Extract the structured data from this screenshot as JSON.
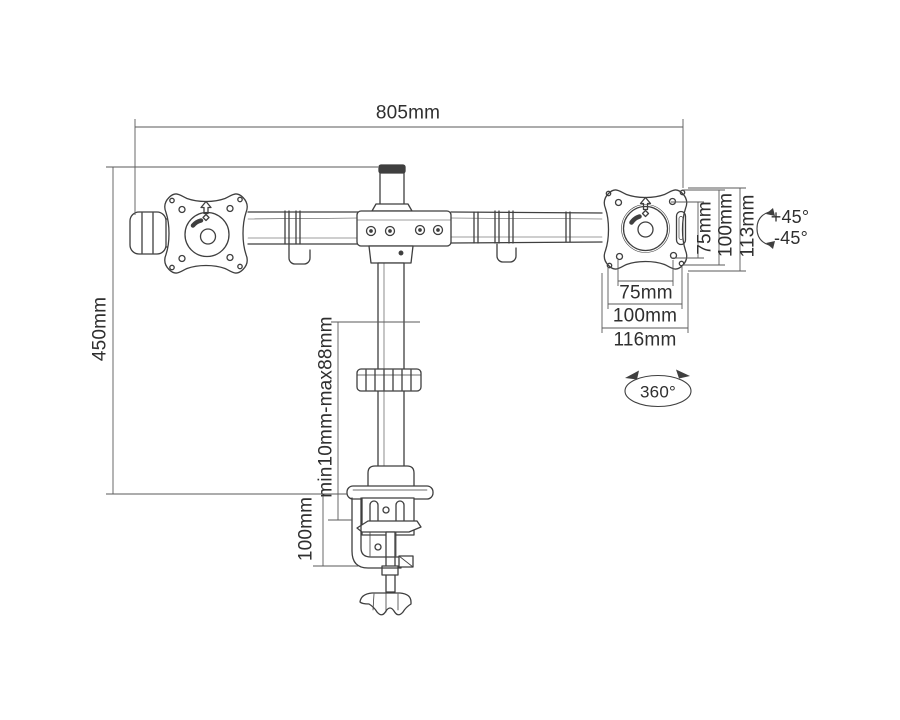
{
  "diagram": {
    "type": "technical-dimension-drawing",
    "subject": "dual monitor desk mount arm with C-clamp base",
    "colors": {
      "background": "#ffffff",
      "line": "#3f3f3f",
      "dimension_line": "#5a5a5a",
      "text": "#2f2f2f"
    },
    "dimensions": {
      "arm_width": "805mm",
      "pole_height": "450mm",
      "vesa_vertical_inner": "75mm",
      "vesa_vertical_outer": "100mm",
      "plate_height": "113mm",
      "tilt_up": "+45°",
      "tilt_down": "-45°",
      "vesa_horizontal_inner": "75mm",
      "vesa_horizontal_outer": "100mm",
      "plate_width": "116mm",
      "swivel_rotation": "360°",
      "clamp_range": "min10mm-max88mm",
      "clamp_height": "100mm"
    }
  }
}
